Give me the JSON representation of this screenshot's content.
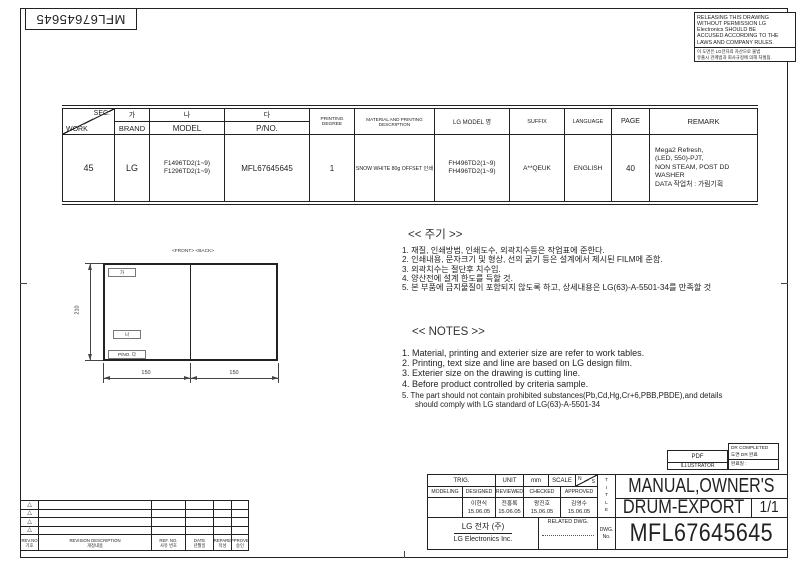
{
  "colors": {
    "ink": "#222222",
    "paper": "#ffffff"
  },
  "sheet": {
    "part_no_rotated": "MFL67645645"
  },
  "warning": {
    "en_lines": [
      "RELEASING THIS DRAWING",
      "WITHOUT PERMISSION LG",
      "Electronics SHOULD BE",
      "ACCUSED ACCORDING TO THE",
      "LAWS AND COMPANY RULES."
    ],
    "ko_lines": [
      "이 도면은 LG전자의 자산으로 불법",
      "유출시 관계법과 회사규정에 의해 처벌됨."
    ]
  },
  "work_table": {
    "header": {
      "sec": "SEC.",
      "work": "WORK",
      "brand_ko": "가",
      "brand": "BRAND",
      "model_ko": "나",
      "model": "MODEL",
      "pno_ko": "다",
      "pno": "P/NO.",
      "printing_degree": "PRINTING DEGREE",
      "material": "MATERIAL AND PRINTING DESCRIPTION",
      "lg_model": "LG MODEL 명",
      "suffix": "SUFFIX",
      "language": "LANGUAGE",
      "page": "PAGE",
      "remark": "REMARK"
    },
    "row": {
      "sec": "45",
      "brand": "LG",
      "model": "F1496TD2(1~9)\nF1296TD2(1~9)",
      "pno": "MFL67645645",
      "printing_degree": "1",
      "material": "SNOW WHITE 80g OFFSET 인쇄",
      "lg_model": "FH496TD2(1~9)\nFH496TD2(1~9)",
      "suffix": "A**QEUK",
      "language": "ENGLISH",
      "page": "40",
      "remark": "Mega2 Refresh,\n(LED, 550)-PJT,\nNON STEAM, POST DD\nWASHER\nDATA 작업처 : 가림기획"
    }
  },
  "drawing": {
    "front_back_label": "<FRONT> <BACK>",
    "height_dim": "210",
    "width_dim_left": "150",
    "width_dim_right": "150",
    "label_ga": "가",
    "label_na": "나",
    "label_pno": "P/NO. 다"
  },
  "notes_ko": {
    "title": "<< 주기 >>",
    "items": [
      "1. 재질, 인쇄방법, 인쇄도수, 외곽치수등은 작업표에 준한다.",
      "2. 인쇄내용, 문자크기 및 형상, 선의 굵기 등은 설계에서 제시된 FILM에 준함.",
      "3. 외곽치수는 절단후 치수임.",
      "4. 양산전에 설계 한도를 득할 것.",
      "5. 본 부품에 금지물질이 포함되지 않도록 하고, 상세내용은 LG(63)-A-5501-34를 만족할 것"
    ]
  },
  "notes_en": {
    "title": "<< NOTES >>",
    "items": [
      "1. Material, printing and exterier size are refer to work tables.",
      "2. Printing, text size and line are based on LG design film.",
      "3. Exterier size on the drawing is cutting line.",
      "4. Before product controlled by criteria sample.",
      "5. The part should not contain prohibited substances(Pb,Cd,Hg,Cr+6,PBB,PBDE),and details\n      should comply with LG standard of LG(63)-A-5501-34"
    ]
  },
  "revision_table": {
    "marker": "△",
    "headers": {
      "rev_no": "REV.NO\n기호",
      "description": "REVISION DESCRIPTION\n개정내용",
      "ref_no": "REF. NO.\n사유 번호",
      "date": "DATE\n년월일",
      "prepared": "PREPARED\n작성",
      "approved": "APPROVED\n승인"
    }
  },
  "title_block": {
    "pdf_label": "PDF",
    "illustrator_label": "ILLUSTRATOR",
    "dr_completed": "DR COMPLETED",
    "dr_completed_ko": "도면 DR 완료",
    "dr_date_label": "완료일 :",
    "trig": "TRIG.",
    "unit_label": "UNIT",
    "unit_value": "mm",
    "scale_label": "SCALE",
    "scale_n": "N",
    "scale_s": "S",
    "cols": [
      "MODELING",
      "DESIGNED",
      "REVIEWED",
      "CHECKED",
      "APPROVED"
    ],
    "signers": [
      "",
      "이현식\n15.06.05",
      "전홍록\n15.06.05",
      "왕진호\n15.06.05",
      "김영수\n15.06.05"
    ],
    "company_ko": "LG 전자   (주)",
    "company_en": "LG Electronics Inc.",
    "related_dwg": "RELATED DWG.",
    "title_vertical": "T\nI\nT\nL\nE",
    "dwg_no_label": "DWG.\nNo.",
    "title_line1": "MANUAL,OWNER'S",
    "title_line2": "DRUM-EXPORT",
    "sheet_no": "1/1",
    "dwg_no": "MFL67645645"
  }
}
